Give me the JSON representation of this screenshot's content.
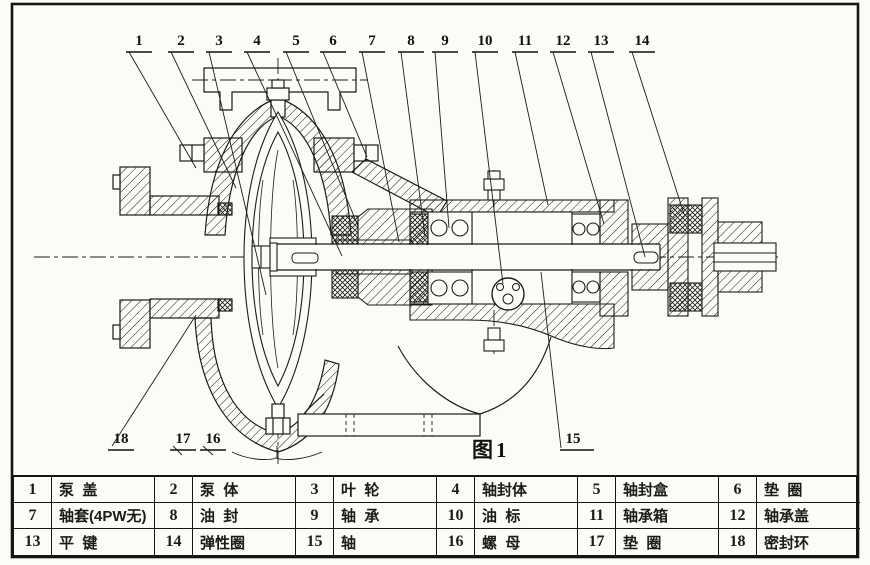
{
  "figure_label": "图1",
  "callouts": {
    "top": [
      "1",
      "2",
      "3",
      "4",
      "5",
      "6",
      "7",
      "8",
      "9",
      "10",
      "11",
      "12",
      "13",
      "14"
    ],
    "bottom": [
      "18",
      "17",
      "16",
      "15"
    ]
  },
  "parts": [
    {
      "num": "1",
      "name": "泵  盖"
    },
    {
      "num": "2",
      "name": "泵  体"
    },
    {
      "num": "3",
      "name": "叶  轮"
    },
    {
      "num": "4",
      "name": "轴封体"
    },
    {
      "num": "5",
      "name": "轴封盒"
    },
    {
      "num": "6",
      "name": "垫  圈"
    },
    {
      "num": "7",
      "name": "轴套(4PW无)"
    },
    {
      "num": "8",
      "name": "油  封"
    },
    {
      "num": "9",
      "name": "轴  承"
    },
    {
      "num": "10",
      "name": "油  标"
    },
    {
      "num": "11",
      "name": "轴承箱"
    },
    {
      "num": "12",
      "name": "轴承盖"
    },
    {
      "num": "13",
      "name": "平  键"
    },
    {
      "num": "14",
      "name": "弹性圈"
    },
    {
      "num": "15",
      "name": "轴"
    },
    {
      "num": "16",
      "name": "螺  母"
    },
    {
      "num": "17",
      "name": "垫  圈"
    },
    {
      "num": "18",
      "name": "密封环"
    }
  ],
  "colors": {
    "ink": "#1b1b1b",
    "paper": "#fbfbf7"
  }
}
